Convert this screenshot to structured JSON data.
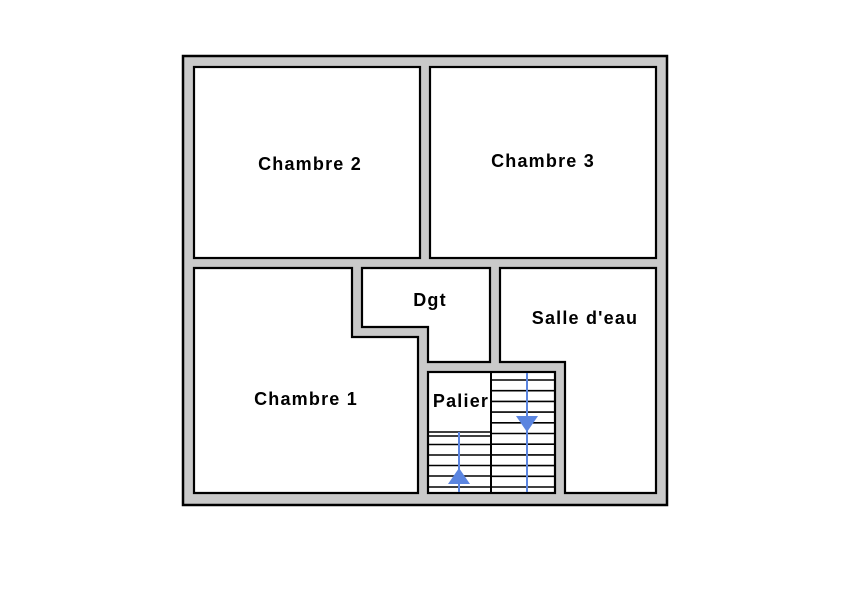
{
  "floor_plan": {
    "rooms": [
      {
        "id": "chambre2",
        "label": "Chambre 2"
      },
      {
        "id": "chambre3",
        "label": "Chambre 3"
      },
      {
        "id": "chambre1",
        "label": "Chambre 1"
      },
      {
        "id": "dgt",
        "label": "Dgt"
      },
      {
        "id": "salle_deau",
        "label": "Salle d'eau"
      },
      {
        "id": "palier",
        "label": "Palier"
      }
    ],
    "staircase": {
      "flights": [
        {
          "side": "left",
          "direction": "up"
        },
        {
          "side": "right",
          "direction": "down"
        }
      ]
    },
    "colors": {
      "wall": "#c9c9c9",
      "outline": "#000000",
      "room": "#ffffff",
      "stair_arrow": "#5b85e0"
    }
  }
}
